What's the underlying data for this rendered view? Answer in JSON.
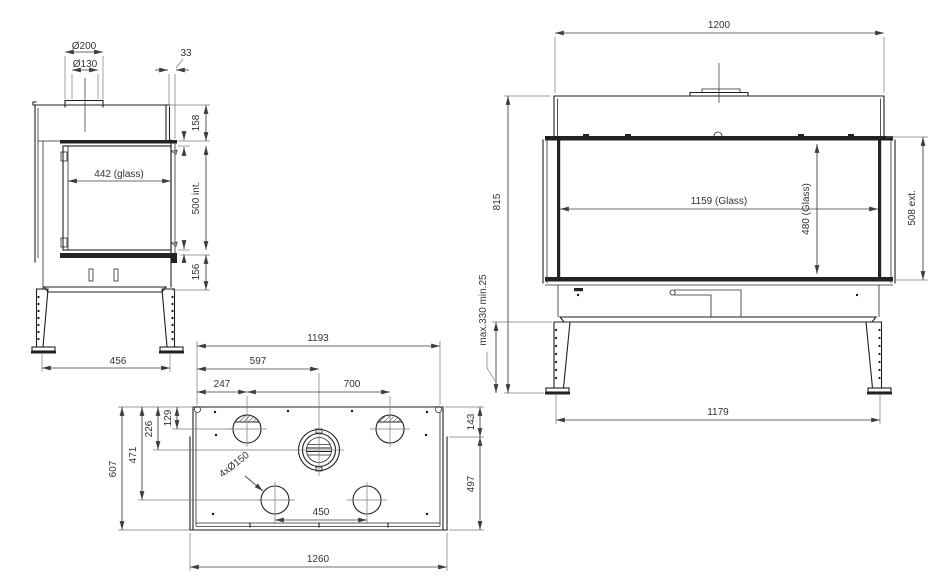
{
  "colors": {
    "background": "#ffffff",
    "object_line": "#1f1f1f",
    "dimension_line": "#3d3d3d",
    "dimension_text": "#333333"
  },
  "drawing": {
    "side_view": {
      "flue_outer_dia": "Ø200",
      "flue_inner_dia": "Ø130",
      "glass_offset": "33",
      "hood_height": "158",
      "gap_top": "4",
      "glass_width": "442 (glass)",
      "interior_height": "500 int.",
      "gap_bottom": "4",
      "plinth_height": "156",
      "feet_spacing": "456"
    },
    "front_view": {
      "overall_width": "1200",
      "overall_height": "815",
      "glass_width": "1159 (Glass)",
      "glass_height": "480 (Glass)",
      "exterior_height": "508 ext.",
      "leg_adjust_range": "max.330 min.25",
      "feet_spacing": "1179"
    },
    "plan_view": {
      "inner_width": "1193",
      "flue_offset": "597",
      "hole1_offset": "247",
      "hole_spacing": "700",
      "hole_row_depth": "129",
      "flue_row_depth": "226",
      "rear_hole_row_depth": "471",
      "inner_depth": "607",
      "front_band_depth": "143",
      "side_depth": "497",
      "holes_note": "4xØ150",
      "rear_hole_spacing": "450",
      "overall_width": "1260"
    }
  }
}
